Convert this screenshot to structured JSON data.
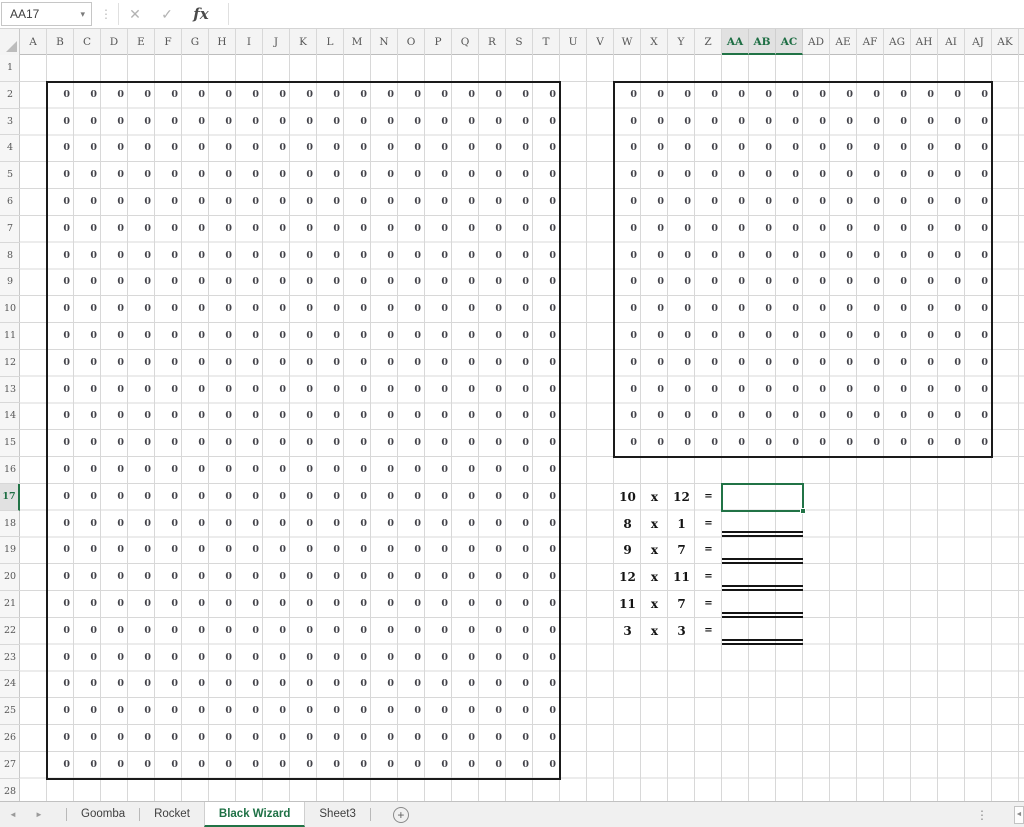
{
  "formula_bar": {
    "name_box_value": "AA17",
    "formula_value": ""
  },
  "icons": {
    "name_box_dropdown": "▾",
    "separator_dots": "⋮",
    "cancel": "✕",
    "confirm": "✓",
    "insert_function": "fx",
    "tab_prev": "◄",
    "tab_next": "►",
    "add_sheet": "+",
    "tabbar_dots": "⋮",
    "hscroll_left": "◄"
  },
  "grid": {
    "columns": [
      "A",
      "B",
      "C",
      "D",
      "E",
      "F",
      "G",
      "H",
      "I",
      "J",
      "K",
      "L",
      "M",
      "N",
      "O",
      "P",
      "Q",
      "R",
      "S",
      "T",
      "U",
      "V",
      "W",
      "X",
      "Y",
      "Z",
      "AA",
      "AB",
      "AC",
      "AD",
      "AE",
      "AF",
      "AG",
      "AH",
      "AI",
      "AJ",
      "AK"
    ],
    "row_numbers": [
      1,
      2,
      3,
      4,
      5,
      6,
      7,
      8,
      9,
      10,
      11,
      12,
      13,
      14,
      15,
      16,
      17,
      18,
      19,
      20,
      21,
      22,
      23,
      24,
      25,
      26,
      27,
      28
    ],
    "selected_columns": [
      "AA",
      "AB",
      "AC"
    ],
    "selected_row": 17,
    "fill_regions": [
      {
        "name": "left-grid",
        "col_start": "B",
        "col_end": "T",
        "row_start": 2,
        "row_end": 27,
        "value": "0"
      },
      {
        "name": "right-grid",
        "col_start": "W",
        "col_end": "AJ",
        "row_start": 2,
        "row_end": 15,
        "value": "0"
      }
    ],
    "selection": {
      "active_cell": "AA17",
      "col_start": "AA",
      "col_end": "AC",
      "row": 17
    }
  },
  "problems": {
    "layout": {
      "factor1_col": "W",
      "operator_col": "X",
      "factor2_col": "Y",
      "equals_col": "Z",
      "answer_col_start": "AA",
      "answer_col_end": "AC"
    },
    "items": [
      {
        "row": 17,
        "factor1": "10",
        "operator": "x",
        "factor2": "12",
        "equals": "=",
        "answer": "",
        "underlined": false
      },
      {
        "row": 18,
        "factor1": "8",
        "operator": "x",
        "factor2": "1",
        "equals": "=",
        "answer": "",
        "underlined": true
      },
      {
        "row": 19,
        "factor1": "9",
        "operator": "x",
        "factor2": "7",
        "equals": "=",
        "answer": "",
        "underlined": true
      },
      {
        "row": 20,
        "factor1": "12",
        "operator": "x",
        "factor2": "11",
        "equals": "=",
        "answer": "",
        "underlined": true
      },
      {
        "row": 21,
        "factor1": "11",
        "operator": "x",
        "factor2": "7",
        "equals": "=",
        "answer": "",
        "underlined": true
      },
      {
        "row": 22,
        "factor1": "3",
        "operator": "x",
        "factor2": "3",
        "equals": "=",
        "answer": "",
        "underlined": true
      }
    ]
  },
  "sheet_tabs": [
    {
      "label": "Goomba",
      "active": false
    },
    {
      "label": "Rocket",
      "active": false
    },
    {
      "label": "Black Wizard",
      "active": true
    },
    {
      "label": "Sheet3",
      "active": false
    }
  ],
  "colors": {
    "accent_green": "#217346",
    "selected_header_bg": "#e1e1e1",
    "header_bg": "#f4f4f4",
    "gridline": "#d8d8d8",
    "range_border": "#1a1a1a",
    "tabbar_bg": "#f0f0f0"
  }
}
